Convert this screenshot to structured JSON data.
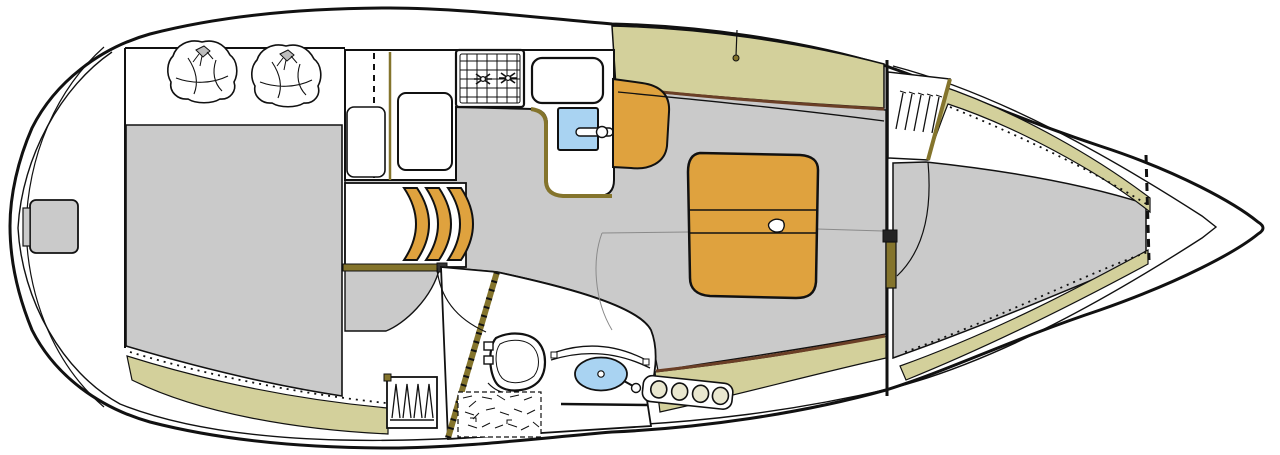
{
  "diagram": {
    "type": "sailboat-interior-floorplan",
    "orientation": {
      "bow": "right",
      "stern": "left"
    },
    "compartments": [
      {
        "id": "aft-cabin",
        "name": "Aft double cabin"
      },
      {
        "id": "galley",
        "name": "Galley"
      },
      {
        "id": "companionway",
        "name": "Companionway steps"
      },
      {
        "id": "head",
        "name": "Head / wet room"
      },
      {
        "id": "salon",
        "name": "Salon with dinette"
      },
      {
        "id": "forward-cabin",
        "name": "Forward V-berth cabin"
      },
      {
        "id": "anchor-locker",
        "name": "Anchor locker / bow"
      }
    ],
    "features": [
      "transom-step",
      "aft-berth",
      "pillows",
      "nav-locker",
      "icebox-lid",
      "two-burner-stove",
      "galley-sink",
      "faucet",
      "steps-x3",
      "toilet",
      "washbasin",
      "shower-grate",
      "hanging-locker-head",
      "hanging-locker-forward",
      "dinette-table",
      "cup-holder",
      "settee",
      "bottle-rack",
      "v-berth",
      "forward-cabin-door",
      "side-deck-bands",
      "hull-outline"
    ]
  },
  "palette": {
    "hull_line": "#111111",
    "deck": "#ffffff",
    "sole": "#cacaca",
    "khaki": "#d3d09b",
    "wood": "#dfa23e",
    "olive": "#84742c",
    "brown": "#6b3f26",
    "blue": "#a9d3f2",
    "rack_fill": "#e9e7cf",
    "knot_gray": "#bdbdbd"
  }
}
